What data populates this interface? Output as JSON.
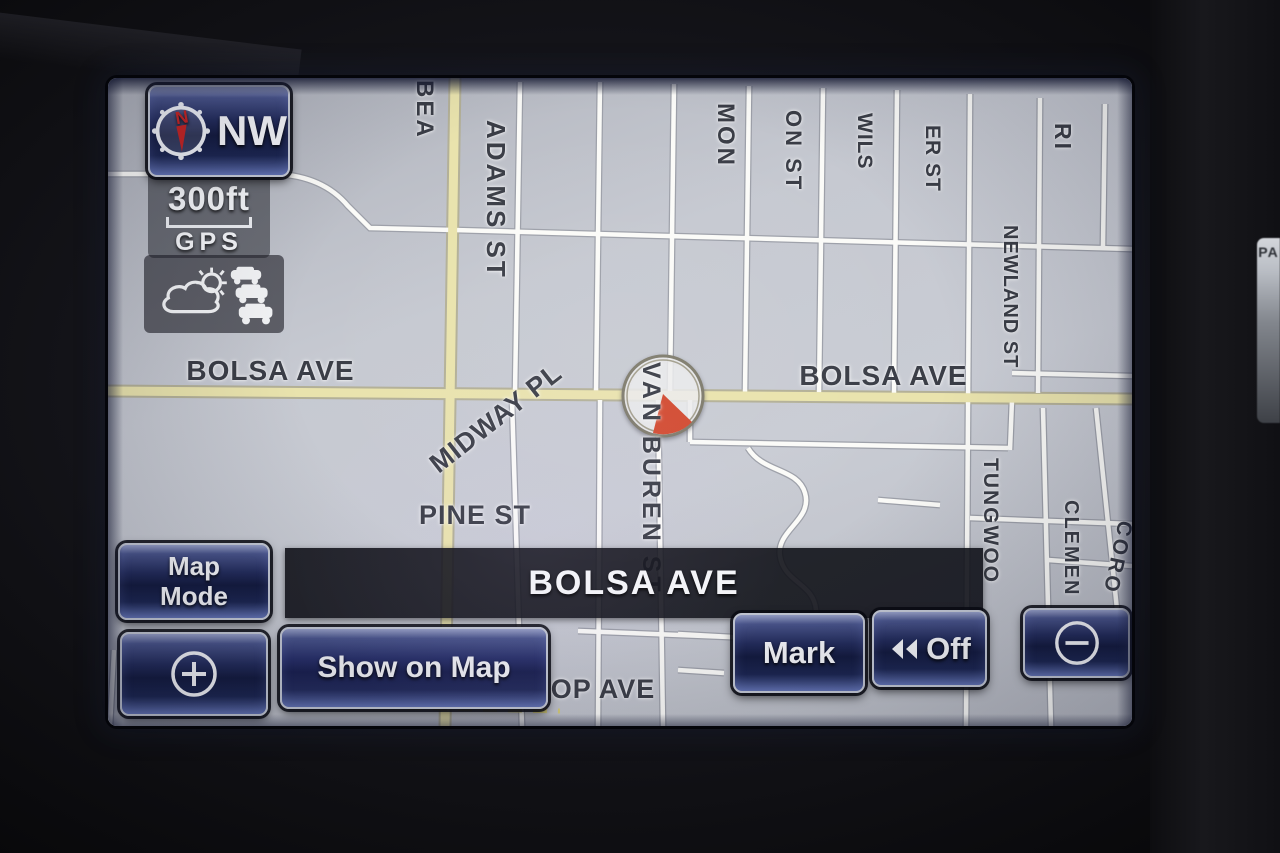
{
  "screen": {
    "type": "car-navigation-map"
  },
  "compass": {
    "label": "NW",
    "icon": "compass-rose-icon"
  },
  "scale": {
    "value": "300ft",
    "source": "GPS"
  },
  "indicators": {
    "weather": "weather-icon",
    "traffic": "traffic-icon"
  },
  "position_bar": {
    "street": "BOLSA AVE"
  },
  "buttons": {
    "map_mode": {
      "label": "Map Mode"
    },
    "zoom_in": {
      "label": "+",
      "icon": "plus-circle-icon"
    },
    "show_on_map": {
      "label": "Show on Map"
    },
    "mark": {
      "label": "Mark"
    },
    "off": {
      "label": "Off",
      "icon": "double-left-arrow-icon"
    },
    "zoom_out": {
      "label": "−",
      "icon": "minus-circle-icon"
    }
  },
  "bezel": {
    "side_button_label": "PA"
  },
  "map": {
    "colors": {
      "background": "#c2c5cd",
      "road_minor": "#fbfbf8",
      "road_major": "#e9e3ad",
      "label_text": "#3a3d46",
      "bar": "#17181d",
      "button_navy": "#1b2550",
      "marker_red": "#d24a30"
    },
    "position_marker": "current-location-marker",
    "labels": [
      {
        "text": "BEA",
        "orientation": "vertical"
      },
      {
        "text": "ADAMS ST",
        "orientation": "vertical"
      },
      {
        "text": "MON",
        "orientation": "vertical"
      },
      {
        "text": "ON ST",
        "orientation": "vertical"
      },
      {
        "text": "WILS",
        "orientation": "vertical"
      },
      {
        "text": "ER ST",
        "orientation": "vertical"
      },
      {
        "text": "RI",
        "orientation": "vertical"
      },
      {
        "text": "NEWLAND ST",
        "orientation": "vertical"
      },
      {
        "text": "BOLSA AVE",
        "orientation": "horizontal"
      },
      {
        "text": "BOLSA AVE",
        "orientation": "horizontal"
      },
      {
        "text": "MIDWAY PL",
        "orientation": "diagonal"
      },
      {
        "text": "PINE ST",
        "orientation": "horizontal"
      },
      {
        "text": "VAN BUREN ST",
        "orientation": "vertical"
      },
      {
        "text": "TUNGWOO",
        "orientation": "vertical"
      },
      {
        "text": "CLEMEN",
        "orientation": "vertical"
      },
      {
        "text": "CORO",
        "orientation": "vertical"
      },
      {
        "text": "OP AVE",
        "orientation": "horizontal"
      }
    ]
  }
}
